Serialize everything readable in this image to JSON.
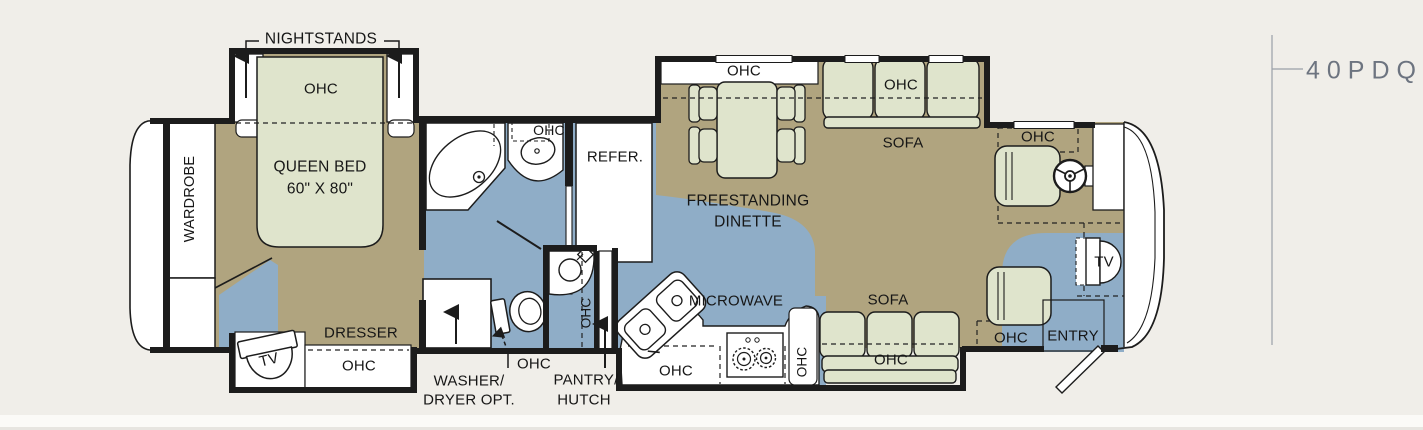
{
  "callout": {
    "model": "40PDQ"
  },
  "colors": {
    "background": "#f0eee9",
    "floor_carpet": "#b0a47f",
    "floor_tile": "#8fadc7",
    "furniture": "#dfe4cc",
    "wall": "#1c1c1c",
    "callout_text": "#6d7480"
  },
  "bedroom": {
    "nightstands": "NIGHTSTANDS",
    "ohc_bed": "OHC",
    "bed_line1": "QUEEN BED",
    "bed_line2": "60\" X 80\"",
    "wardrobe": "WARDROBE",
    "dresser": "DRESSER",
    "tv": "TV",
    "ohc_slide": "OHC"
  },
  "bath": {
    "ohc_vanity": "OHC",
    "washer_line1": "WASHER/",
    "washer_line2": "DRYER OPT.",
    "ohc_toilet": "OHC",
    "pantry_line1": "PANTRY/",
    "pantry_line2": "HUTCH",
    "ohc_midbath": "OHC"
  },
  "kitchen": {
    "refer": "REFER.",
    "microwave": "MICROWAVE",
    "ohc_sink": "OHC",
    "ohc_counter": "OHC"
  },
  "living": {
    "ohc_dinette": "OHC",
    "dinette_line1": "FREESTANDING",
    "dinette_line2": "DINETTE",
    "sofa_top": "SOFA",
    "ohc_sofa_top": "OHC",
    "sofa_bottom": "SOFA",
    "ohc_sofa_bottom": "OHC"
  },
  "cockpit": {
    "ohc_driver": "OHC",
    "ohc_passenger": "OHC",
    "entry": "ENTRY",
    "tv": "TV"
  }
}
